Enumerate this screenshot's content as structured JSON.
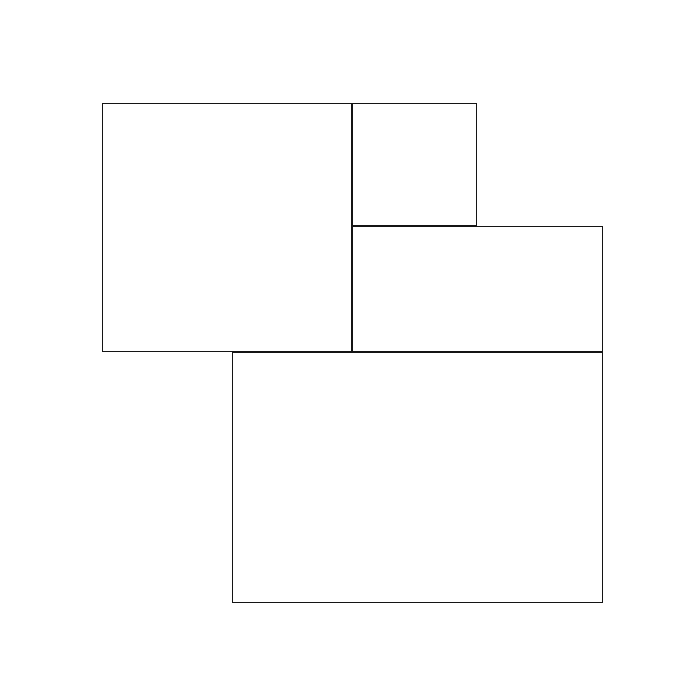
{
  "canvas": {
    "width": 700,
    "height": 700,
    "background_color": "#ffffff"
  },
  "style": {
    "stroke_color": "#141414",
    "stroke_width": 1,
    "fill_color": "#ffffff"
  },
  "shapes": [
    {
      "name": "left-square",
      "type": "rect",
      "x": 102,
      "y": 103,
      "width": 250,
      "height": 249
    },
    {
      "name": "top-small-square",
      "type": "rect",
      "x": 352,
      "y": 103,
      "width": 125,
      "height": 123
    },
    {
      "name": "right-rectangle",
      "type": "rect",
      "x": 352,
      "y": 226,
      "width": 251,
      "height": 126
    },
    {
      "name": "bottom-rectangle",
      "type": "rect",
      "x": 232,
      "y": 352,
      "width": 371,
      "height": 251
    }
  ]
}
